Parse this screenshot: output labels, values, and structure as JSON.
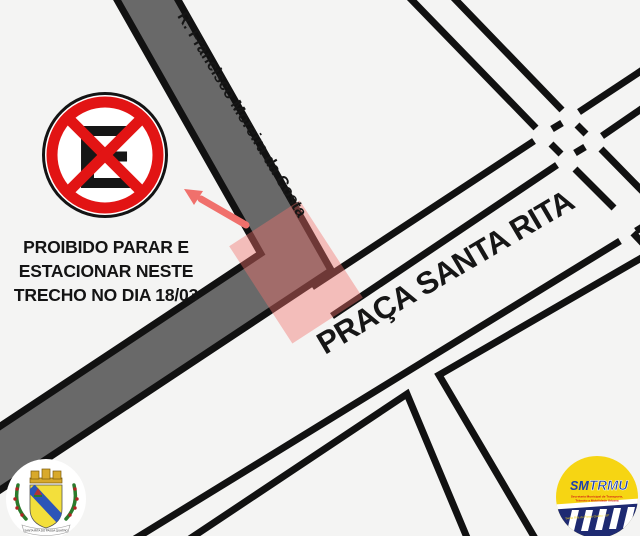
{
  "streets": {
    "rua": "R. Francisco Moreira da Costa",
    "praca": "PRAÇA SANTA RITA"
  },
  "notice": {
    "lines": [
      "PROIBIDO PARAR E",
      "ESTACIONAR NESTE",
      "TRECHO NO DIA 18/03"
    ]
  },
  "sign": {
    "letter": "E"
  },
  "logos": {
    "crest": {
      "banner": "SANTA RITA DO PASSA QUATRO"
    },
    "smtrmu": {
      "left": "SM",
      "right": "TRMU",
      "sub1": "Secretaria Municipal de Transporte,",
      "sub2": "Trânsito e Mobilidade Urbana",
      "footer": "Santa Rita do Passa Quatro - SP"
    }
  },
  "colors": {
    "background": "#f4f4f3",
    "road_fill": "#696969",
    "line": "#111111",
    "sign_red": "#e21414",
    "highlight": "#f0706c",
    "logo_yellow": "#f6d513",
    "logo_navy": "#1e2a72"
  }
}
